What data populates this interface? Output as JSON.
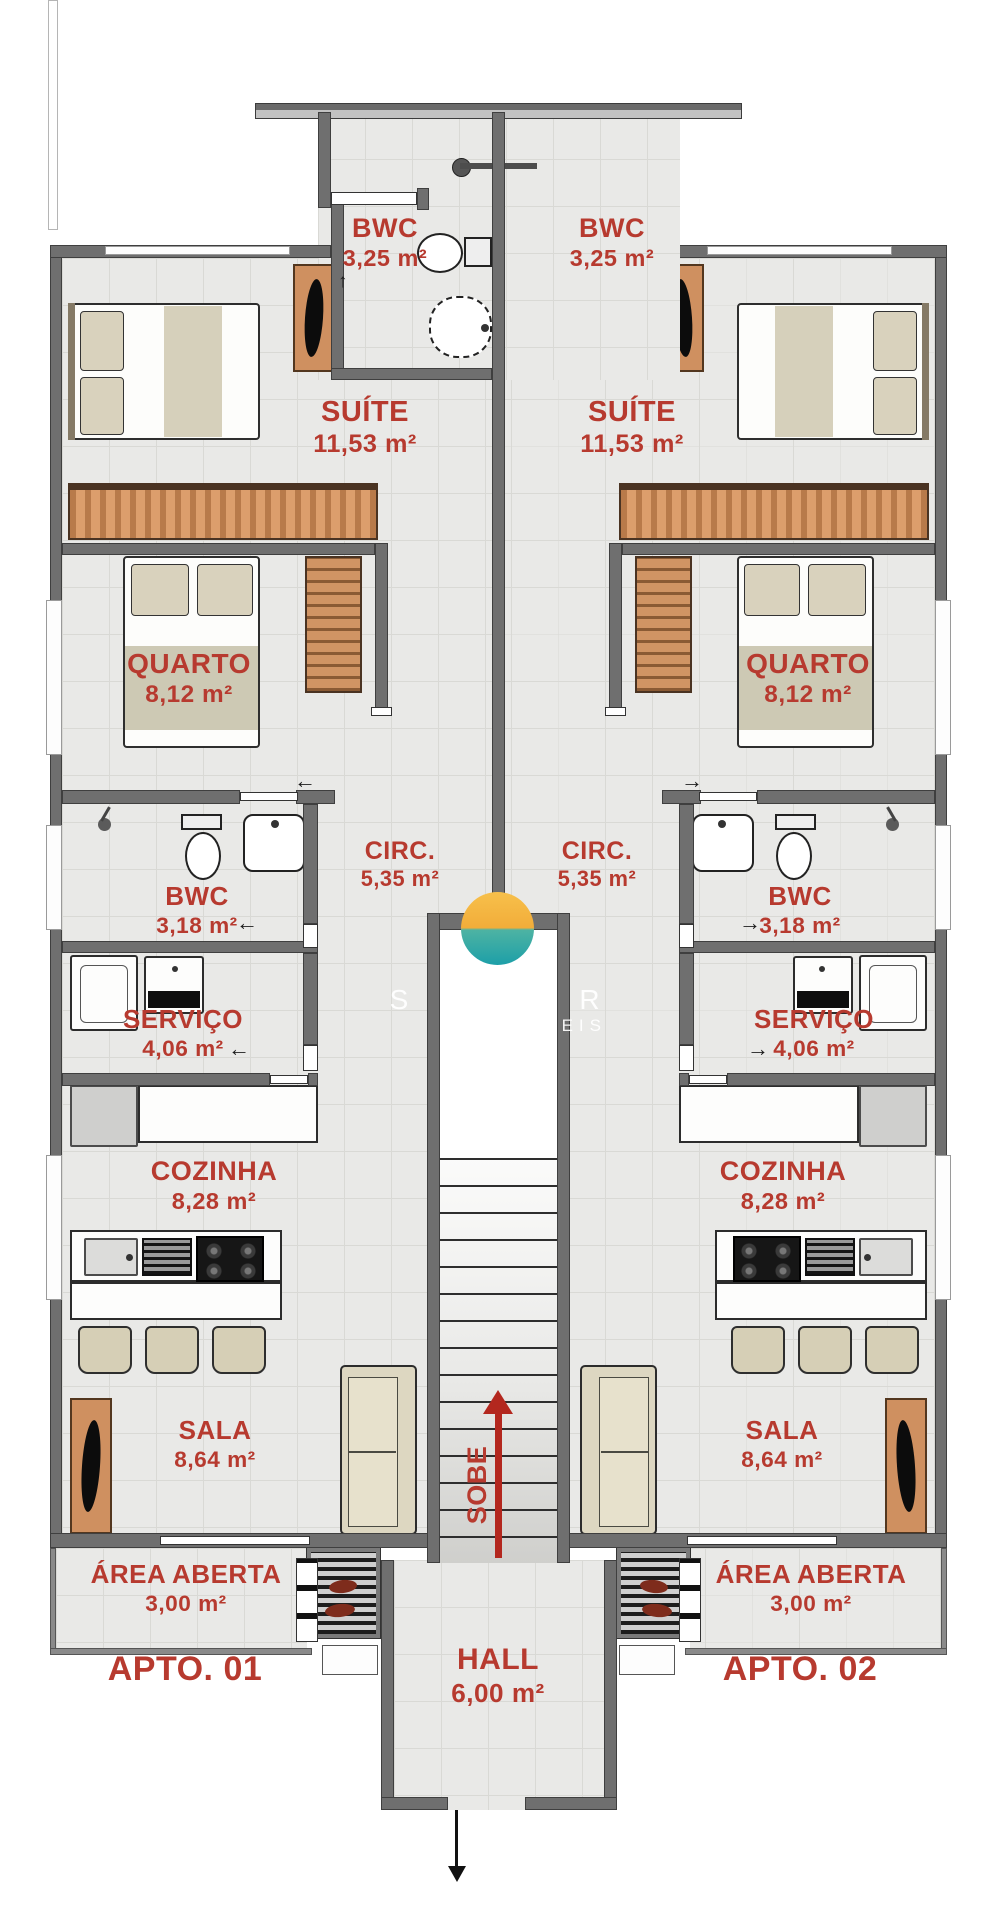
{
  "rooms": {
    "bwc_top": {
      "name": "BWC",
      "area": "3,25 m²"
    },
    "suite": {
      "name": "SUÍTE",
      "area": "11,53 m²"
    },
    "quarto": {
      "name": "QUARTO",
      "area": "8,12 m²"
    },
    "circ": {
      "name": "CIRC.",
      "area": "5,35 m²"
    },
    "bwc": {
      "name": "BWC",
      "area": "3,18 m²"
    },
    "servico": {
      "name": "SERVIÇO",
      "area": "4,06 m²"
    },
    "cozinha": {
      "name": "COZINHA",
      "area": "8,28 m²"
    },
    "sala": {
      "name": "SALA",
      "area": "8,64 m²"
    },
    "area_aberta": {
      "name": "ÁREA ABERTA",
      "area": "3,00 m²"
    },
    "hall": {
      "name": "HALL",
      "area": "6,00 m²"
    }
  },
  "units": {
    "apto1": "APTO. 01",
    "apto2": "APTO. 02"
  },
  "stairs": {
    "direction_label": "SOBE"
  },
  "watermark": {
    "fragment_left": "S",
    "fragment_right": "A R",
    "fragment_line2": "ÓVEIS"
  },
  "colors": {
    "label_red": "#b73a2f",
    "arrow_red": "#b3271e",
    "wall_gray": "#6f6f6f",
    "floor_gray": "#e9e9e7",
    "wood": "#cf9060",
    "watermark_orange": "#f5b843",
    "watermark_teal": "#25a3a5"
  }
}
